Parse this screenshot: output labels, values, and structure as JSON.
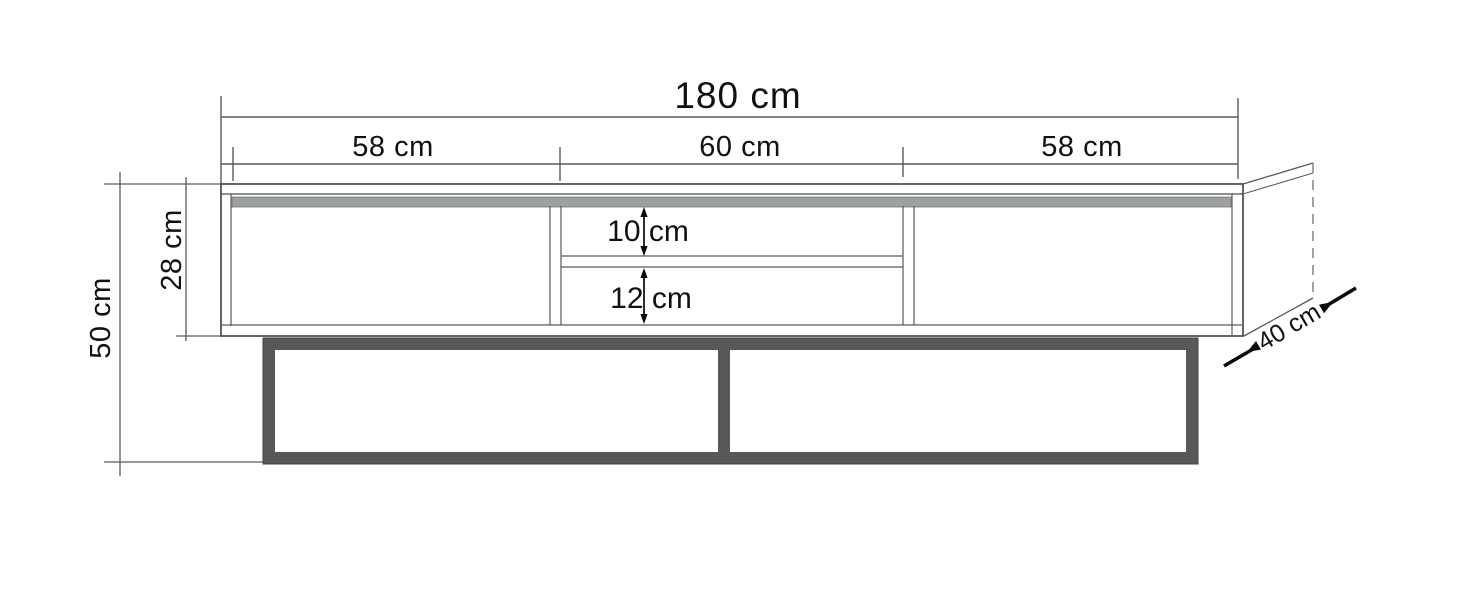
{
  "diagram": {
    "kind": "furniture-dimension-drawing",
    "subject": "tv-stand-front-view-with-depth-perspective",
    "labels": {
      "total_width": "180 cm",
      "section_left": "58 cm",
      "section_middle": "60 cm",
      "section_right": "58 cm",
      "total_height": "50 cm",
      "cabinet_height": "28 cm",
      "opening_top": "10 cm",
      "opening_bottom": "12 cm",
      "depth": "40 cm"
    },
    "values_cm": {
      "total_width": 180,
      "sections": [
        58,
        60,
        58
      ],
      "total_height": 50,
      "cabinet_height": 28,
      "opening_top": 10,
      "opening_bottom": 12,
      "depth": 40
    },
    "colors": {
      "background": "#ffffff",
      "outline": "#4a4a4a",
      "dimension_line": "#5a5a5a",
      "dashed_edge": "#7c7c7c",
      "top_strip": "#9da0a1",
      "base_frame": "#57585a",
      "arrow": "#0a0a0a",
      "text": "#111111"
    }
  }
}
